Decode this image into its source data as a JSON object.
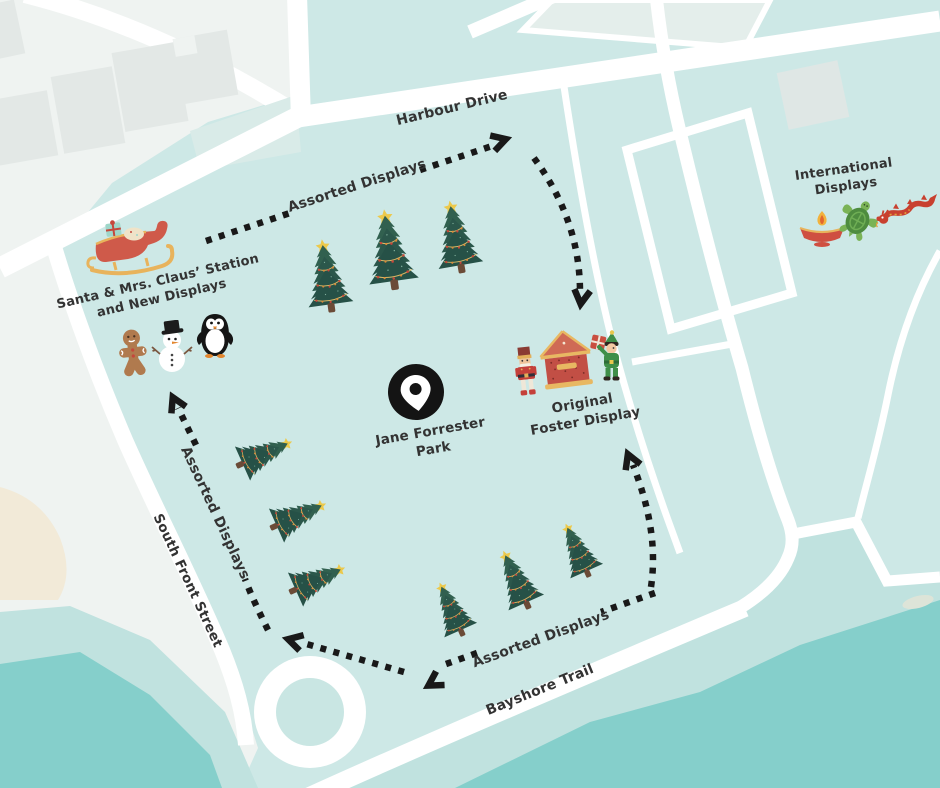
{
  "map_subject": "Jane Forrester Park holiday displays map",
  "colors": {
    "park_green": "#cde8e6",
    "water": "#85cfcb",
    "shore": "#c0e2df",
    "road_white": "#ffffff",
    "pale_district": "#eff3f1",
    "building_gray": "#e3e8e6",
    "sand": "#f2ead8",
    "route_black": "#191919",
    "label_text": "#333333",
    "tree_green": "#2e5b50",
    "star_gold": "#ecc94b",
    "sleigh_red": "#cf5a4a",
    "trim_gold": "#e8b35c"
  },
  "roads": {
    "harbour_drive": "Harbour Drive",
    "south_front_street": "South Front Street",
    "bayshore_trail": "Bayshore Trail"
  },
  "park": {
    "name_line1": "Jane Forrester",
    "name_line2": "Park",
    "pin_icon": "location-pin"
  },
  "stations": {
    "santa": {
      "line1": "Santa & Mrs. Claus’ Station",
      "line2": "and New Displays",
      "icons": [
        "sleigh-icon",
        "gingerbread-man-icon",
        "snowman-icon",
        "penguin-icon"
      ]
    },
    "original_foster": {
      "line1": "Original",
      "line2": "Foster Display",
      "icons": [
        "nutcracker-icon",
        "gingerbread-house-icon",
        "elf-icon"
      ]
    },
    "international": {
      "line1": "International",
      "line2": "Displays",
      "icons": [
        "diya-lamp-icon",
        "sea-turtle-icon",
        "dragon-icon"
      ]
    }
  },
  "route_labels": {
    "top": "Assorted Displays",
    "left": "Assorted Displays",
    "bottom": "Assorted Displays"
  }
}
